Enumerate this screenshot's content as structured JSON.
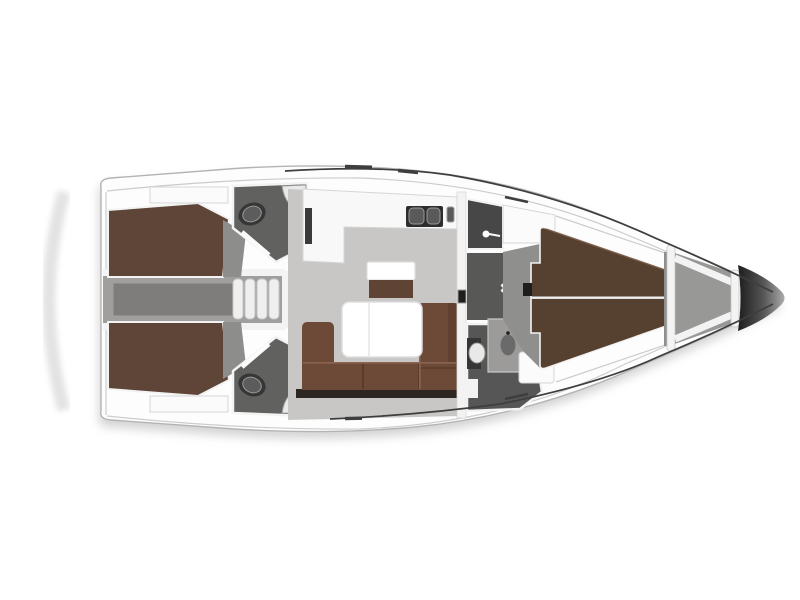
{
  "figure": {
    "counts": {
      "companionway_steps": 4,
      "anchor_locker_struts": 4
    }
  },
  "colors": {
    "background": "#ffffff",
    "hull_fill": "#fdfdfd",
    "hull_stroke": "#b4b4b4",
    "deck_line": "#cccccc",
    "gunwale": "#3e3e3e",
    "shadow": "#a8a8a8",
    "transom": "#dedede",
    "wall": "#f3f3f3",
    "wall_stroke": "#d6d6d6",
    "floor": "#c8c7c5",
    "corridor": "#a09f9d",
    "engine_hatch": "#7e7d7b",
    "step_fill": "#efefef",
    "step_stroke": "#c6c6c6",
    "head_floor": "#616160",
    "shower_floor": "#474747",
    "passage_floor": "#585857",
    "mid_head_floor": "#575656",
    "locker_floor": "#989896",
    "bow_floor": "#8f8f8d",
    "berth_aft": "#5e4538",
    "berth_fwd": "#56402f",
    "berth_edge": "#7a5a48",
    "sofa": "#6d4a38",
    "sofa_seam": "#553826",
    "sofa_highlight": "#8a6450",
    "sofa_plinth": "#2e2620",
    "stool_wood": "#5f4334",
    "table_fill": "#ffffff",
    "table_stroke": "#dedede",
    "counter": "#f8f8f8",
    "appliance_dark": "#3a3a3a",
    "sink_unit": "#2d2d2d",
    "sink_basin": "#5a5a5a",
    "sink_rim": "#989898",
    "toilet_base": "#363636",
    "toilet_seat": "#5c5c5c",
    "toilet_white": "#e9e9e9",
    "fixture_white": "#fbfbfb",
    "sink_vanity": "#9c9b9a",
    "basin_dark": "#6a6a6a",
    "panel_dark": "#1e1e1e",
    "bow_dark": "#1d1d1d",
    "bow_mid": "#565656",
    "bow_light": "#ababab",
    "wedge_gray": "#8d8d8b"
  }
}
